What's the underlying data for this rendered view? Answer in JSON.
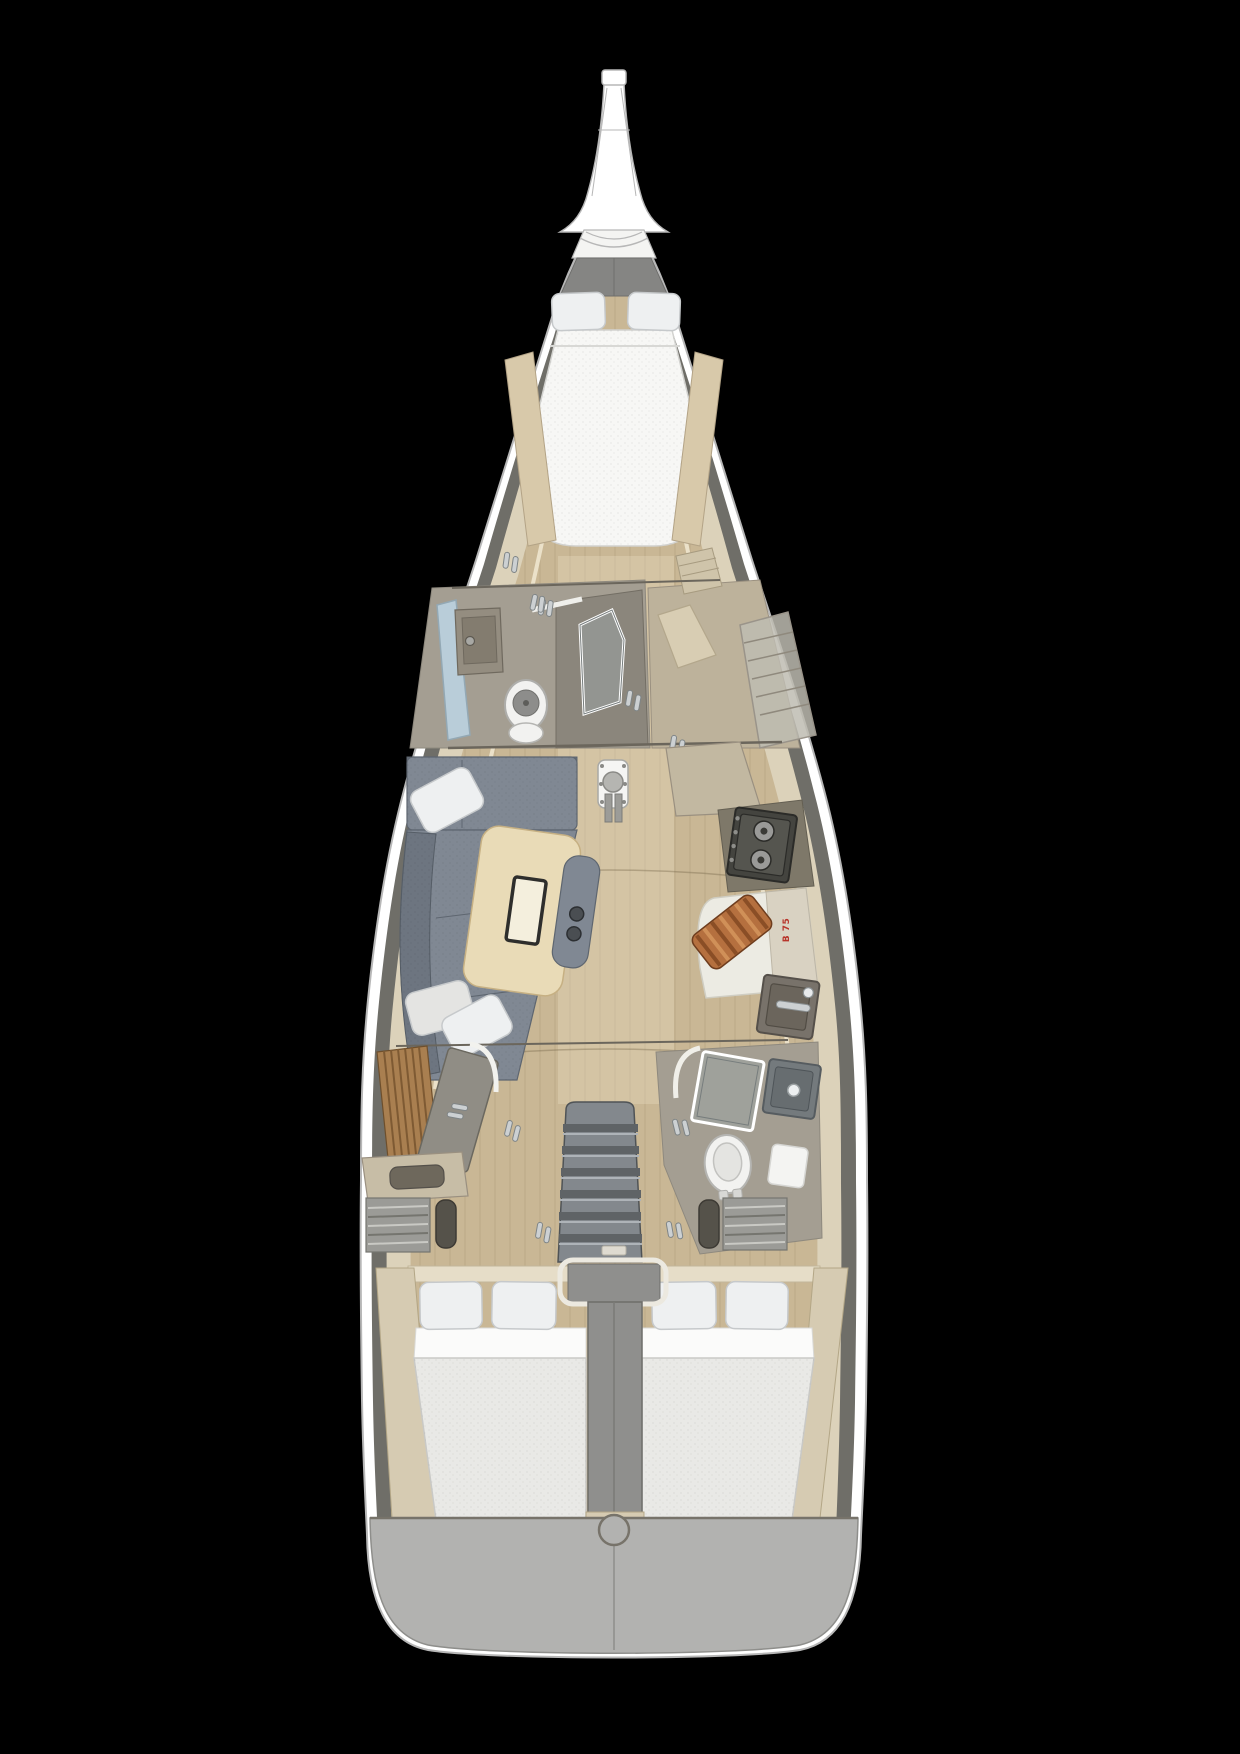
{
  "labels": {
    "galley_plate": "B 75"
  },
  "palette": {
    "background": "#000000",
    "hull_white": "#ffffff",
    "hull_outline": "#b7b7b7",
    "liner_dark": "#6f6e68",
    "liner_cream": "#dcd2ba",
    "liner_cream_bright": "#f1e9d2",
    "floor_wood": "#c9b795",
    "floor_wood_light": "#d8c9aa",
    "deck_white": "#f4f4f2",
    "anchor_gray": "#858583",
    "berth_white": "#f7f7f5",
    "pillow_white": "#eef0f1",
    "pillow_shadow": "#c6c9cb",
    "sofa_gray": "#808893",
    "sofa_gray_dark": "#6d7580",
    "table_wood": "#e9dbb7",
    "table_slot_edge": "#2e2e2c",
    "head_wall": "#b4ad9f",
    "head_floor": "#a49e92",
    "window_blue": "#b9cdd9",
    "glass_gray": "#9aa3a3",
    "toilet_white": "#f2f2f0",
    "stove_dark": "#44443f",
    "stove_surround": "#7e7869",
    "burner_gray": "#9a9a98",
    "counter_beige": "#c2b8a1",
    "counter_white": "#ecebe3",
    "counter_panel": "#d9d2c2",
    "board_orange": "#b5703f",
    "board_stripe": "#8a4e26",
    "board_stripe_light": "#d09058",
    "sink_dark": "#78726a",
    "chrome": "#ccd0d2",
    "teak": "#a97f50",
    "teak_dark": "#7e5a33",
    "steps_gray": "#83888d",
    "step_shadow": "#5f6366",
    "column_gray": "#8f8f8d",
    "bed_sheet": "#fbfbfa",
    "bed_mattress": "#e9e9e6",
    "bed_line": "#c9c9c6",
    "transom_gray": "#b2b2b0",
    "vent_gray": "#9b9b97",
    "door_gray": "#908d85",
    "label_red": "#b8342a",
    "bulkhead_line": "#6b665c"
  }
}
